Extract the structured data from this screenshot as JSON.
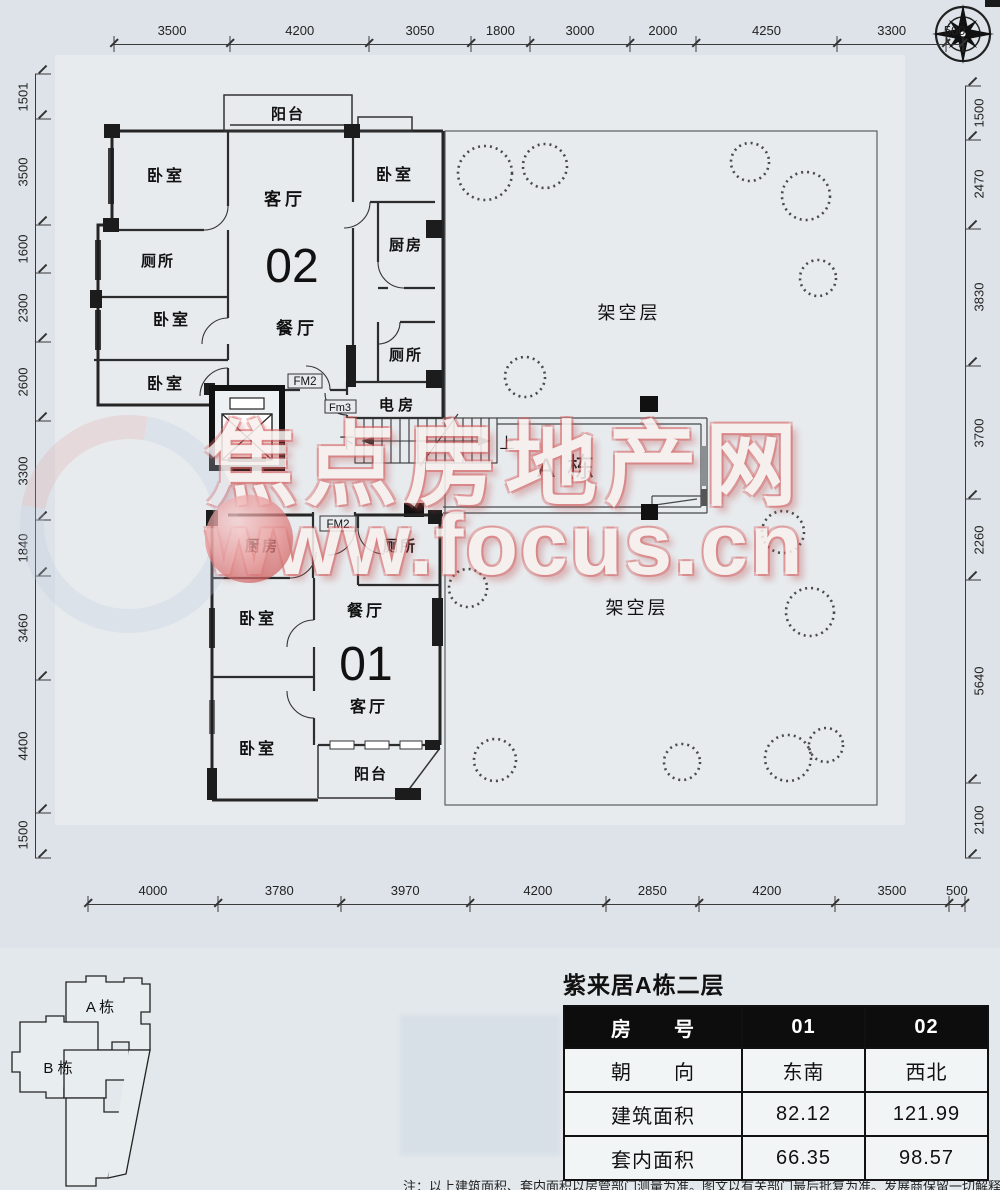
{
  "dimensions": {
    "top": [
      "3500",
      "4200",
      "3050",
      "1800",
      "3000",
      "2000",
      "4250",
      "3300",
      "500"
    ],
    "left": [
      "1501",
      "3500",
      "1600",
      "2300",
      "2600",
      "3300",
      "1840",
      "3460",
      "4400",
      "1500"
    ],
    "right": [
      "1500",
      "2470",
      "3830",
      "3700",
      "2260",
      "5640",
      "2100"
    ],
    "bottom": [
      "4000",
      "3780",
      "3970",
      "4200",
      "2850",
      "4200",
      "3500",
      "500"
    ]
  },
  "labels": {
    "balcony": "阳台",
    "bedroom": "卧室",
    "living_room": "客厅",
    "toilet": "厕所",
    "kitchen": "厨房",
    "dining_room": "餐厅",
    "electric_room": "电 房",
    "stilt_floor": "架空层",
    "building_a": "A 栋",
    "unit_02": "02",
    "unit_01": "01",
    "door_fm2": "FM2",
    "door_fm3": "Fm3",
    "stair_down": "下",
    "stair_up": "上"
  },
  "site_plan": {
    "building_a": "A 栋",
    "building_b": "B 栋"
  },
  "watermark": {
    "line1": "焦点房地产网",
    "line2": "www.focus.cn"
  },
  "info": {
    "title": "紫来居A栋二层",
    "table": {
      "header": [
        "房　　号",
        "01",
        "02"
      ],
      "rows": [
        [
          "朝　　向",
          "东南",
          "西北"
        ],
        [
          "建筑面积",
          "82.12",
          "121.99"
        ],
        [
          "套内面积",
          "66.35",
          "98.57"
        ]
      ]
    },
    "note": "注：以上建筑面积、套内面积以房管部门测量为准。图文以有关部门最后批复为准。发展商保留一切解释权利"
  }
}
